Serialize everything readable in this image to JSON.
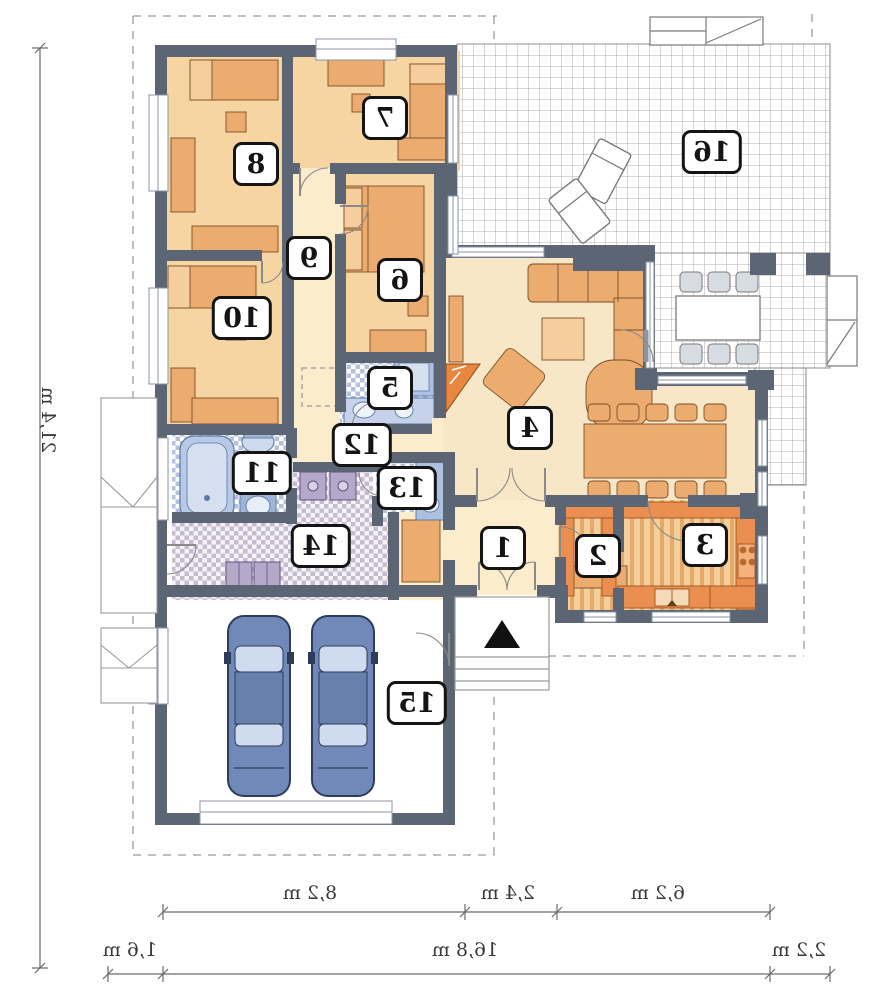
{
  "plan": {
    "type": "house-floor-plan-mirrored",
    "rooms": [
      {
        "number": "1"
      },
      {
        "number": "2"
      },
      {
        "number": "3"
      },
      {
        "number": "4"
      },
      {
        "number": "5"
      },
      {
        "number": "6"
      },
      {
        "number": "7"
      },
      {
        "number": "8"
      },
      {
        "number": "9"
      },
      {
        "number": "10"
      },
      {
        "number": "11"
      },
      {
        "number": "12"
      },
      {
        "number": "13"
      },
      {
        "number": "14"
      },
      {
        "number": "15"
      },
      {
        "number": "16"
      }
    ],
    "dimensions": {
      "vertical": "21,4 m",
      "top_row": [
        {
          "label": "8,2 m"
        },
        {
          "label": "2,4 m"
        },
        {
          "label": "6,2 m"
        }
      ],
      "bottom_row": [
        {
          "label": "1,6 m"
        },
        {
          "label": "16,8 m"
        },
        {
          "label": "2,2 m"
        }
      ]
    },
    "colors": {
      "wall": "#5c6573",
      "bedroom_floor": "#f6d5a2",
      "hall_floor": "#fbeccc",
      "living_floor": "#f8e7c6",
      "furniture_tan": "#ecab6f",
      "kitchen_counter": "#ea8f50",
      "bath_blue": "#b9c9e4",
      "car_body": "#7089b8",
      "fireplace_orange": "#e8873f"
    }
  }
}
